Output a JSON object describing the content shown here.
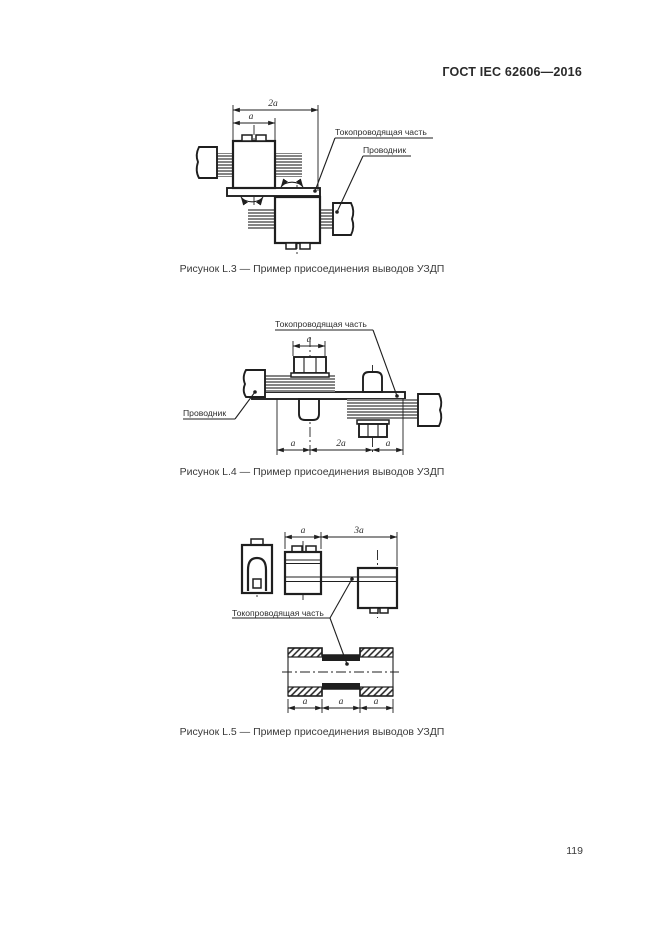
{
  "document": {
    "header_title": "ГОСТ IEC 62606—2016",
    "page_number": "119"
  },
  "figures": {
    "l3": {
      "caption": "Рисунок L.3 — Пример присоединения выводов УЗДП",
      "label_conductive_part": "Токопроводящая часть",
      "label_conductor": "Проводник",
      "dim_2a": "2а",
      "dim_a": "а"
    },
    "l4": {
      "caption": "Рисунок L.4 — Пример присоединения выводов УЗДП",
      "label_conductive_part": "Токопроводящая часть",
      "label_conductor": "Проводник",
      "dim_top_a": "а",
      "dim_bottom_a1": "а",
      "dim_bottom_2a": "2а",
      "dim_bottom_a2": "а"
    },
    "l5": {
      "caption": "Рисунок L.5 — Пример присоединения выводов УЗДП",
      "label_conductive_part": "Токопроводящая часть",
      "dim_top_a": "а",
      "dim_top_3a": "3а",
      "dim_bottom_a1": "а",
      "dim_bottom_a2": "а",
      "dim_bottom_a3": "а"
    }
  }
}
